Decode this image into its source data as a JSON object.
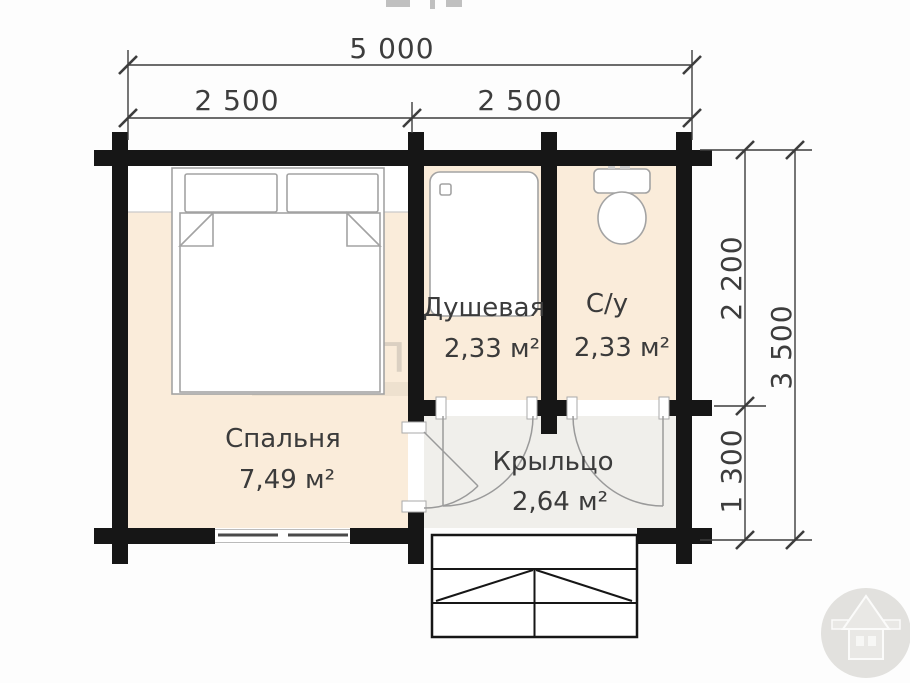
{
  "dimensions": {
    "top_total": "5 000",
    "top_left": "2 500",
    "top_right": "2 500",
    "right_upper": "2 200",
    "right_lower": "1 300",
    "right_total": "3 500"
  },
  "rooms": {
    "bedroom": {
      "name": "Спальня",
      "area": "7,49 м²"
    },
    "shower": {
      "name": "Душевая",
      "area": "2,33 м²"
    },
    "wc": {
      "name": "С/у",
      "area": "2,33 м²"
    },
    "porch": {
      "name": "Крыльцо",
      "area": "2,64 м²"
    }
  },
  "watermark": {
    "text": "Альп"
  },
  "colors": {
    "wall": "#161616",
    "room_fill": "#faecda",
    "porch_fill": "#f0efeb",
    "furniture_line": "#9a9a9a",
    "dimension": "#3d3d3d",
    "logo_circle": "#e2e1de"
  }
}
